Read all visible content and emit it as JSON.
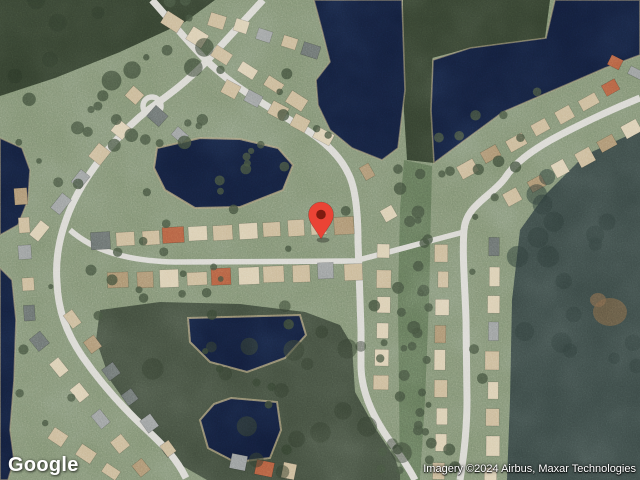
{
  "map": {
    "logo": "Google",
    "attribution": "Imagery ©2024 Airbus, Maxar Technologies"
  },
  "marker": {
    "color": "#EA4335",
    "dot_color": "#7E1B10"
  },
  "colors": {
    "grass": "#7d8e70",
    "grass_light": "#93a07e",
    "forest": "#3f4a3b",
    "forest_right": "#384643",
    "forest_dark": "#313d2c",
    "corridor": "#5f7355",
    "water": "#111c38",
    "shore": "#a89b77",
    "road": "#d7d6d0",
    "roof_tan": "#c8b694",
    "roof_light": "#d8cbae",
    "roof_gray": "#979b9b",
    "roof_brown": "#a88f6c",
    "roof_dark": "#666d6b",
    "roof_red": "#b05a3c",
    "tree": "#3e4c39",
    "pin": "#EA4335",
    "pin_dot": "#7E1B10"
  }
}
